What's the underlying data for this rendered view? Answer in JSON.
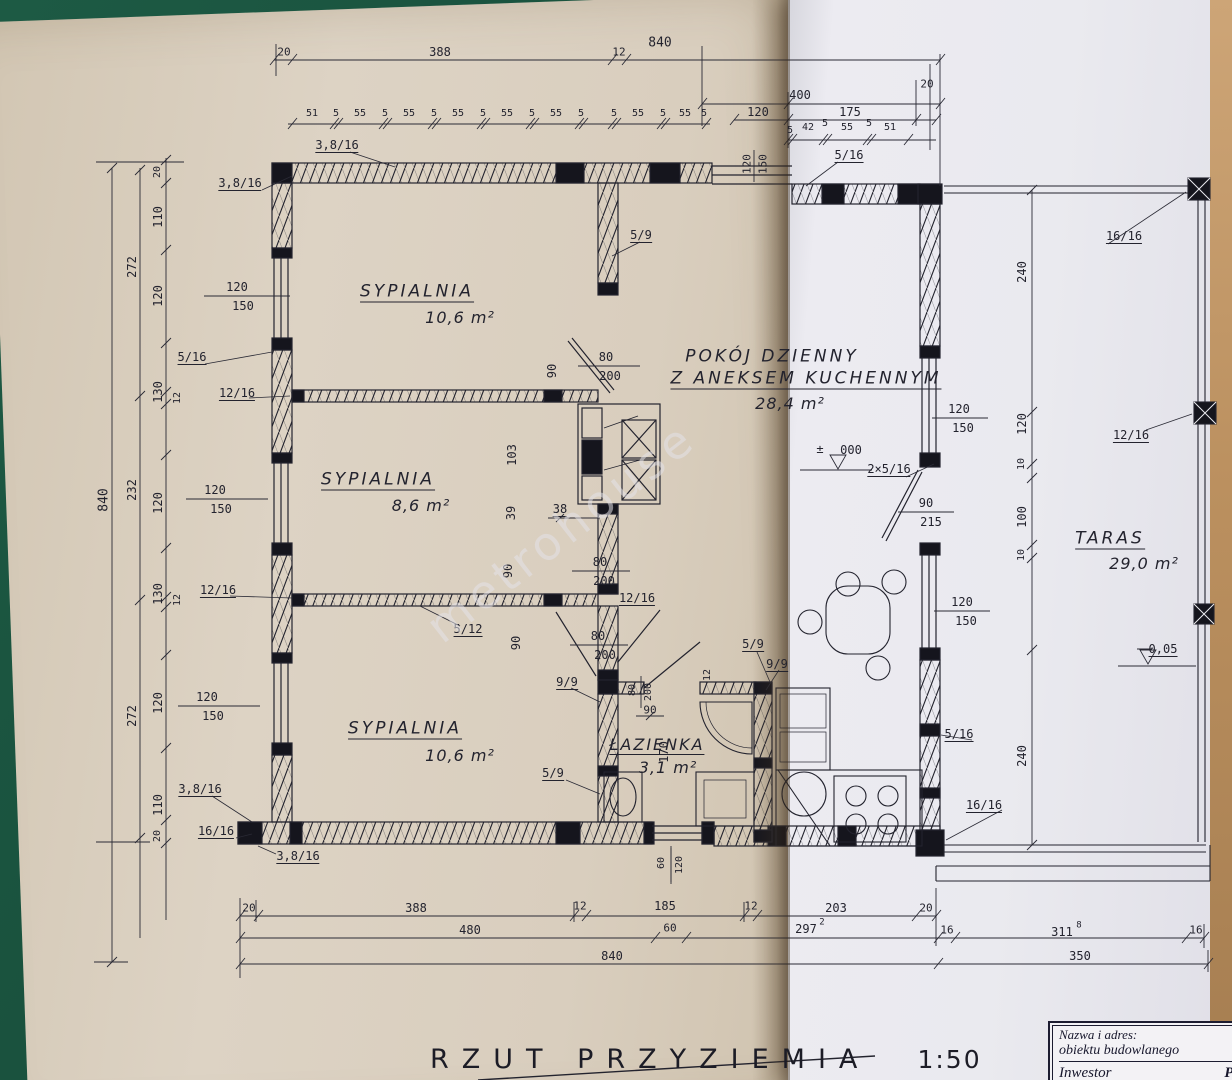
{
  "page": {
    "watermark": "metrohouse",
    "drawing_title": "RZUT PRZYZIEMIA",
    "drawing_scale": "1:50",
    "title_block": {
      "line1": "Nazwa i adres:",
      "line2": "obiektu budowlanego",
      "investor_label": "Inwestor",
      "investor_value": "Pa"
    },
    "rooms": [
      {
        "name": "SYPIALNIA",
        "area": "10,6 m²"
      },
      {
        "name": "SYPIALNIA",
        "area": "8,6 m²"
      },
      {
        "name": "SYPIALNIA",
        "area": "10,6 m²"
      },
      {
        "name": "ŁAZIENKA",
        "area": "3,1 m²"
      },
      {
        "name": "POKÓJ DZIENNY Z ANEKSEM KUCHENNYM",
        "area": "28,4 m²"
      },
      {
        "name": "TARAS",
        "area": "29,0 m²"
      }
    ],
    "levels": [
      "± 000",
      "- 0,05"
    ],
    "colors": {
      "page_left": "#d9cebe",
      "page_right": "#eaeaef",
      "ink": "#23232e",
      "table_green": "#1d5a44",
      "edge_tan": "#bb905f"
    },
    "labels": [
      {
        "t": "20",
        "x": 284,
        "y": 52,
        "s": 11
      },
      {
        "t": "388",
        "x": 440,
        "y": 52
      },
      {
        "t": "12",
        "x": 619,
        "y": 52,
        "s": 11
      },
      {
        "t": "840",
        "x": 660,
        "y": 43,
        "s": 13
      },
      {
        "t": "400",
        "x": 800,
        "y": 95
      },
      {
        "t": "120",
        "x": 758,
        "y": 112
      },
      {
        "t": "175",
        "x": 850,
        "y": 112
      },
      {
        "t": "20",
        "x": 927,
        "y": 84,
        "s": 11
      },
      {
        "t": "51",
        "x": 312,
        "y": 114,
        "s": 10
      },
      {
        "t": "5",
        "x": 336,
        "y": 114,
        "s": 10
      },
      {
        "t": "55",
        "x": 360,
        "y": 114,
        "s": 10
      },
      {
        "t": "5",
        "x": 385,
        "y": 114,
        "s": 10
      },
      {
        "t": "55",
        "x": 409,
        "y": 114,
        "s": 10
      },
      {
        "t": "5",
        "x": 434,
        "y": 114,
        "s": 10
      },
      {
        "t": "55",
        "x": 458,
        "y": 114,
        "s": 10
      },
      {
        "t": "5",
        "x": 483,
        "y": 114,
        "s": 10
      },
      {
        "t": "55",
        "x": 507,
        "y": 114,
        "s": 10
      },
      {
        "t": "5",
        "x": 532,
        "y": 114,
        "s": 10
      },
      {
        "t": "55",
        "x": 556,
        "y": 114,
        "s": 10
      },
      {
        "t": "5",
        "x": 581,
        "y": 114,
        "s": 10
      },
      {
        "t": "5",
        "x": 614,
        "y": 114,
        "s": 10
      },
      {
        "t": "55",
        "x": 638,
        "y": 114,
        "s": 10
      },
      {
        "t": "5",
        "x": 663,
        "y": 114,
        "s": 10
      },
      {
        "t": "55",
        "x": 685,
        "y": 114,
        "s": 10
      },
      {
        "t": "5",
        "x": 704,
        "y": 114,
        "s": 10
      },
      {
        "t": "5",
        "x": 790,
        "y": 131,
        "s": 10
      },
      {
        "t": "42",
        "x": 808,
        "y": 128,
        "s": 10
      },
      {
        "t": "5",
        "x": 825,
        "y": 124,
        "s": 10
      },
      {
        "t": "55",
        "x": 847,
        "y": 128,
        "s": 10
      },
      {
        "t": "5",
        "x": 869,
        "y": 124,
        "s": 10
      },
      {
        "t": "51",
        "x": 890,
        "y": 128,
        "s": 10
      },
      {
        "t": "3,8/16",
        "x": 337,
        "y": 146,
        "u": 1
      },
      {
        "t": "3,8/16",
        "x": 240,
        "y": 184,
        "u": 1
      },
      {
        "t": "5/16",
        "x": 849,
        "y": 156,
        "u": 1
      },
      {
        "t": "120",
        "x": 747,
        "y": 164,
        "r": -90,
        "s": 11
      },
      {
        "t": "150",
        "x": 763,
        "y": 164,
        "r": -90,
        "s": 11
      },
      {
        "t": "16/16",
        "x": 1124,
        "y": 237,
        "u": 1
      },
      {
        "t": "20",
        "x": 158,
        "y": 172,
        "r": -90,
        "s": 10
      },
      {
        "t": "110",
        "x": 158,
        "y": 217,
        "r": -90
      },
      {
        "t": "120",
        "x": 158,
        "y": 296,
        "r": -90
      },
      {
        "t": "130",
        "x": 158,
        "y": 392,
        "r": -90
      },
      {
        "t": "120",
        "x": 158,
        "y": 503,
        "r": -90
      },
      {
        "t": "130",
        "x": 158,
        "y": 594,
        "r": -90
      },
      {
        "t": "120",
        "x": 158,
        "y": 703,
        "r": -90
      },
      {
        "t": "110",
        "x": 158,
        "y": 805,
        "r": -90
      },
      {
        "t": "20",
        "x": 158,
        "y": 836,
        "r": -90,
        "s": 10
      },
      {
        "t": "12",
        "x": 178,
        "y": 398,
        "r": -90,
        "s": 10
      },
      {
        "t": "12",
        "x": 178,
        "y": 600,
        "r": -90,
        "s": 10
      },
      {
        "t": "272",
        "x": 132,
        "y": 267,
        "r": -90
      },
      {
        "t": "232",
        "x": 132,
        "y": 490,
        "r": -90
      },
      {
        "t": "272",
        "x": 132,
        "y": 716,
        "r": -90
      },
      {
        "t": "840",
        "x": 104,
        "y": 500,
        "r": -90,
        "s": 13
      },
      {
        "t": "120",
        "x": 237,
        "y": 287
      },
      {
        "t": "150",
        "x": 243,
        "y": 306
      },
      {
        "t": "120",
        "x": 215,
        "y": 490
      },
      {
        "t": "150",
        "x": 221,
        "y": 509
      },
      {
        "t": "120",
        "x": 207,
        "y": 697
      },
      {
        "t": "150",
        "x": 213,
        "y": 716
      },
      {
        "t": "5/16",
        "x": 192,
        "y": 358,
        "u": 1
      },
      {
        "t": "12/16",
        "x": 237,
        "y": 394,
        "u": 1
      },
      {
        "t": "12/16",
        "x": 218,
        "y": 591,
        "u": 1
      },
      {
        "t": "3,8/16",
        "x": 200,
        "y": 790,
        "u": 1
      },
      {
        "t": "16/16",
        "x": 216,
        "y": 832,
        "u": 1
      },
      {
        "t": "3,8/16",
        "x": 298,
        "y": 857,
        "u": 1
      },
      {
        "t": "SYPIALNIA",
        "x": 417,
        "y": 293,
        "c": "room",
        "u": 1,
        "n": "room-name-sypialnia-1"
      },
      {
        "t": "10,6 m²",
        "x": 460,
        "y": 318,
        "c": "area",
        "n": "room-area-sypialnia-1"
      },
      {
        "t": "SYPIALNIA",
        "x": 378,
        "y": 481,
        "c": "room",
        "u": 1,
        "n": "room-name-sypialnia-2"
      },
      {
        "t": "8,6 m²",
        "x": 421,
        "y": 506,
        "c": "area",
        "n": "room-area-sypialnia-2"
      },
      {
        "t": "SYPIALNIA",
        "x": 405,
        "y": 730,
        "c": "room",
        "u": 1,
        "n": "room-name-sypialnia-3"
      },
      {
        "t": "10,6 m²",
        "x": 460,
        "y": 756,
        "c": "area",
        "n": "room-area-sypialnia-3"
      },
      {
        "t": "POKÓJ DZIENNY",
        "x": 772,
        "y": 357,
        "c": "room",
        "n": "room-name-pokoj-dzienny"
      },
      {
        "t": "Z ANEKSEM KUCHENNYM",
        "x": 806,
        "y": 380,
        "c": "room",
        "u": 1,
        "n": "room-name-pokoj-dzienny-line2"
      },
      {
        "t": "28,4 m²",
        "x": 790,
        "y": 404,
        "c": "area",
        "n": "room-area-pokoj-dzienny"
      },
      {
        "t": "ŁAZIENKA",
        "x": 657,
        "y": 746,
        "c": "room2",
        "u": 1,
        "n": "room-name-lazienka"
      },
      {
        "t": "3,1 m²",
        "x": 668,
        "y": 768,
        "c": "area2",
        "n": "room-area-lazienka"
      },
      {
        "t": "TARAS",
        "x": 1110,
        "y": 540,
        "c": "room",
        "u": 1,
        "n": "room-name-taras"
      },
      {
        "t": "29,0 m²",
        "x": 1144,
        "y": 564,
        "c": "area",
        "n": "room-area-taras"
      },
      {
        "t": "5/9",
        "x": 641,
        "y": 236,
        "u": 1
      },
      {
        "t": "80",
        "x": 606,
        "y": 357
      },
      {
        "t": "200",
        "x": 610,
        "y": 376
      },
      {
        "t": "90",
        "x": 552,
        "y": 371,
        "r": -90
      },
      {
        "t": "103",
        "x": 512,
        "y": 455,
        "r": -90
      },
      {
        "t": "39",
        "x": 511,
        "y": 513,
        "r": -90
      },
      {
        "t": "38",
        "x": 560,
        "y": 510,
        "u": 1
      },
      {
        "t": "90",
        "x": 508,
        "y": 571,
        "r": -90
      },
      {
        "t": "80",
        "x": 600,
        "y": 562
      },
      {
        "t": "200",
        "x": 604,
        "y": 581
      },
      {
        "t": "12/16",
        "x": 637,
        "y": 599,
        "u": 1
      },
      {
        "t": "5/12",
        "x": 468,
        "y": 630,
        "u": 1
      },
      {
        "t": "90",
        "x": 516,
        "y": 643,
        "r": -90
      },
      {
        "t": "80",
        "x": 598,
        "y": 636
      },
      {
        "t": "200",
        "x": 605,
        "y": 655
      },
      {
        "t": "9/9",
        "x": 567,
        "y": 683,
        "u": 1
      },
      {
        "t": "5/9",
        "x": 753,
        "y": 645,
        "u": 1
      },
      {
        "t": "9/9",
        "x": 777,
        "y": 665,
        "u": 1
      },
      {
        "t": "12",
        "x": 708,
        "y": 675,
        "r": -90,
        "s": 10
      },
      {
        "t": "80",
        "x": 633,
        "y": 690,
        "r": -90,
        "s": 10
      },
      {
        "t": "200",
        "x": 649,
        "y": 692,
        "r": -90,
        "s": 10
      },
      {
        "t": "90",
        "x": 650,
        "y": 710,
        "s": 11
      },
      {
        "t": "170",
        "x": 664,
        "y": 752,
        "r": -90
      },
      {
        "t": "5/9",
        "x": 553,
        "y": 774,
        "u": 1
      },
      {
        "t": "60",
        "x": 662,
        "y": 863,
        "r": -90,
        "s": 10
      },
      {
        "t": "120",
        "x": 680,
        "y": 865,
        "r": -90,
        "s": 10
      },
      {
        "t": "120",
        "x": 959,
        "y": 409
      },
      {
        "t": "150",
        "x": 963,
        "y": 428
      },
      {
        "t": "±",
        "x": 820,
        "y": 449,
        "s": 12
      },
      {
        "t": "000",
        "x": 851,
        "y": 450
      },
      {
        "t": "2×5/16",
        "x": 889,
        "y": 470,
        "u": 1
      },
      {
        "t": "90",
        "x": 926,
        "y": 503
      },
      {
        "t": "215",
        "x": 931,
        "y": 522
      },
      {
        "t": "120",
        "x": 962,
        "y": 602
      },
      {
        "t": "150",
        "x": 966,
        "y": 621
      },
      {
        "t": "5/16",
        "x": 959,
        "y": 735,
        "u": 1
      },
      {
        "t": "16/16",
        "x": 984,
        "y": 806,
        "u": 1
      },
      {
        "t": "240",
        "x": 1022,
        "y": 272,
        "r": -90
      },
      {
        "t": "120",
        "x": 1022,
        "y": 424,
        "r": -90
      },
      {
        "t": "10",
        "x": 1022,
        "y": 464,
        "r": -90,
        "s": 10
      },
      {
        "t": "100",
        "x": 1022,
        "y": 517,
        "r": -90
      },
      {
        "t": "10",
        "x": 1022,
        "y": 555,
        "r": -90,
        "s": 10
      },
      {
        "t": "240",
        "x": 1022,
        "y": 756,
        "r": -90
      },
      {
        "t": "12/16",
        "x": 1131,
        "y": 436,
        "u": 1
      },
      {
        "t": "0,05",
        "x": 1163,
        "y": 650,
        "u": 1
      },
      {
        "t": "20",
        "x": 249,
        "y": 908,
        "s": 11
      },
      {
        "t": "388",
        "x": 416,
        "y": 908
      },
      {
        "t": "12",
        "x": 580,
        "y": 906,
        "s": 11
      },
      {
        "t": "185",
        "x": 665,
        "y": 906
      },
      {
        "t": "12",
        "x": 751,
        "y": 906,
        "s": 11
      },
      {
        "t": "203",
        "x": 836,
        "y": 908
      },
      {
        "t": "20",
        "x": 926,
        "y": 908,
        "s": 11
      },
      {
        "t": "480",
        "x": 470,
        "y": 930
      },
      {
        "t": "60",
        "x": 670,
        "y": 928,
        "s": 11
      },
      {
        "t": "297",
        "x": 806,
        "y": 929
      },
      {
        "t": "2",
        "x": 822,
        "y": 923,
        "s": 9
      },
      {
        "t": "16",
        "x": 947,
        "y": 930,
        "s": 11
      },
      {
        "t": "311",
        "x": 1062,
        "y": 932
      },
      {
        "t": "8",
        "x": 1079,
        "y": 926,
        "s": 9
      },
      {
        "t": "16",
        "x": 1196,
        "y": 930,
        "s": 11
      },
      {
        "t": "840",
        "x": 612,
        "y": 956
      },
      {
        "t": "350",
        "x": 1080,
        "y": 956
      }
    ]
  }
}
